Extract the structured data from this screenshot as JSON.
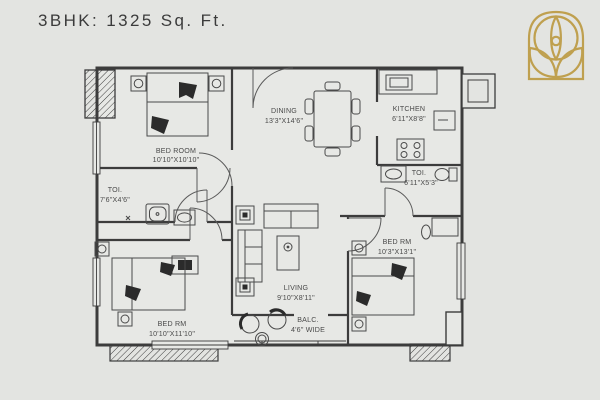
{
  "title": "3BHK: 1325 Sq. Ft.",
  "colors": {
    "background": "#e3e4e1",
    "plan_line": "#3c3c3c",
    "accent_gold": "#bfa04f",
    "title_text": "#3b3b3b"
  },
  "logo": {
    "name": "lotus-arch-emblem"
  },
  "rooms": [
    {
      "id": "bedroom-top-left",
      "name": "BED ROOM",
      "dims": "10'10\"X10'10\""
    },
    {
      "id": "dining",
      "name": "DINING",
      "dims": "13'3\"X14'6\""
    },
    {
      "id": "kitchen",
      "name": "KITCHEN",
      "dims": "6'11\"X8'8\""
    },
    {
      "id": "toilet-left",
      "name": "TOI.",
      "dims": "7'6\"X4'6\""
    },
    {
      "id": "toilet-right",
      "name": "TOI.",
      "dims": "6'11\"X5'3\""
    },
    {
      "id": "living",
      "name": "LIVING",
      "dims": "9'10\"X8'11\""
    },
    {
      "id": "bedroom-right",
      "name": "BED RM",
      "dims": "10'3\"X13'1\""
    },
    {
      "id": "bedroom-bottom-left",
      "name": "BED RM",
      "dims": "10'10\"X11'10\""
    },
    {
      "id": "balcony",
      "name": "BALC.",
      "dims": "4'6\" WIDE"
    }
  ]
}
